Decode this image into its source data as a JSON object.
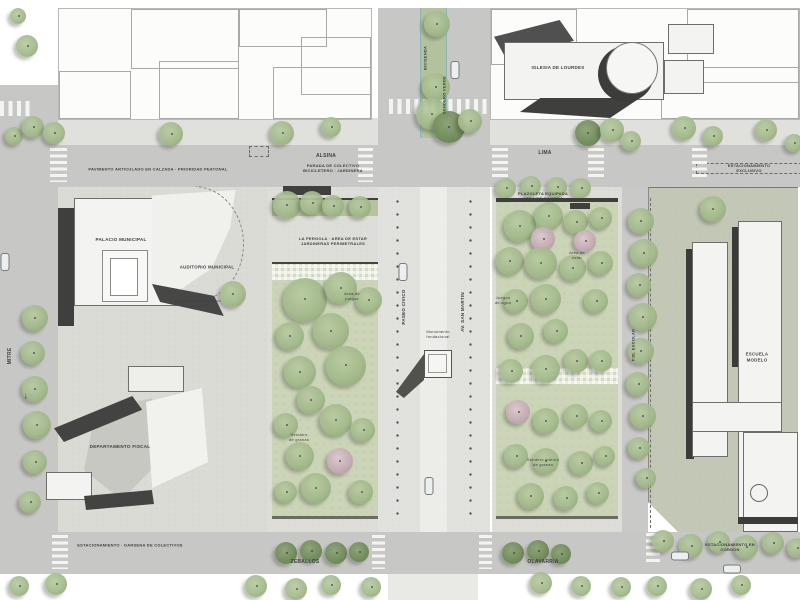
{
  "title": "Plan maestro urbano - plaza civica",
  "palette": {
    "road": "#c7c7c5",
    "sidewalk": "#e0e0dc",
    "plot_civic": "#dbdbd6",
    "plot_school": "#c3c8b6",
    "mall": "#e1e1dd",
    "mall_strip": "#ecece8",
    "lawn": "#cbd4b6",
    "pergola": "#b5c49e",
    "median": "#b2c29c",
    "building_white": "#f3f3f1",
    "building_dark": "#3f3f3d",
    "ink": "#3f4044",
    "tree_green": "#9fb687",
    "tree_dark": "#6f8a58",
    "tree_pink": "#c5abb5"
  },
  "labels": [
    {
      "name": "church-label",
      "text": "IGLESIA DE LOURDES",
      "x": 558,
      "y": 68,
      "size": 4.5,
      "rot": 0,
      "caps": true
    },
    {
      "name": "street-alsina",
      "text": "ALSINA",
      "x": 326,
      "y": 156,
      "size": 5,
      "rot": 0,
      "caps": true
    },
    {
      "name": "street-lima",
      "text": "LIMA",
      "x": 545,
      "y": 153,
      "size": 5,
      "rot": 0,
      "caps": true
    },
    {
      "name": "paving-note",
      "text": "PAVIMENTO ARTICULADO EN CALZADA · PRIORIDAD PEATONAL",
      "x": 158,
      "y": 169,
      "size": 4,
      "rot": 0,
      "caps": true
    },
    {
      "name": "bus-stop-note",
      "text": "PARADA DE COLECTIVO\nBICICLETERO · JARDINERA",
      "x": 333,
      "y": 168,
      "size": 4,
      "rot": 0,
      "caps": true
    },
    {
      "name": "parking-note-top",
      "text": "ESTACIONAMIENTO EXCLUSIVO",
      "x": 749,
      "y": 168,
      "size": 4,
      "rot": 0,
      "caps": true
    },
    {
      "name": "palacio-label",
      "text": "PALACIO MUNICIPAL",
      "x": 121,
      "y": 240,
      "size": 4.6,
      "rot": 0,
      "caps": true
    },
    {
      "name": "auditorio-label",
      "text": "AUDITORIO MUNICIPAL",
      "x": 207,
      "y": 267,
      "size": 4.4,
      "rot": 0,
      "caps": true
    },
    {
      "name": "fiscal-label",
      "text": "DEPARTAMENTO FISCAL",
      "x": 120,
      "y": 447,
      "size": 4.6,
      "rot": 0,
      "caps": true
    },
    {
      "name": "stairs-note",
      "text": "Escalera de desembarco\nal patio civico",
      "x": 196,
      "y": 303,
      "size": 4,
      "rot": 0,
      "caps": false
    },
    {
      "name": "pergola-note",
      "text": "LA PERGOLA · AREA DE ESTAR\nJARDINERAS PERIMETRALES",
      "x": 333,
      "y": 241,
      "size": 4,
      "rot": 0,
      "caps": true
    },
    {
      "name": "playground-note",
      "text": "Area de\njuegos",
      "x": 352,
      "y": 296,
      "size": 4,
      "rot": 0,
      "caps": false
    },
    {
      "name": "gravel-note-left",
      "text": "Sendero\nde granza",
      "x": 299,
      "y": 437,
      "size": 4,
      "rot": 0,
      "caps": false
    },
    {
      "name": "plazoleta-note",
      "text": "PLAZOLETA EQUIPADA\nAREA DE SOMBRA",
      "x": 543,
      "y": 196,
      "size": 4,
      "rot": 0,
      "caps": true
    },
    {
      "name": "seating-note",
      "text": "Area de\nestar",
      "x": 577,
      "y": 255,
      "size": 4,
      "rot": 0,
      "caps": false
    },
    {
      "name": "water-note",
      "text": "Juegos\nde agua",
      "x": 503,
      "y": 300,
      "size": 4,
      "rot": 0,
      "caps": false
    },
    {
      "name": "gravel-note-right",
      "text": "Sendero interno\nde granza",
      "x": 543,
      "y": 462,
      "size": 4,
      "rot": 0,
      "caps": false
    },
    {
      "name": "school-label",
      "text": "ESCUELA MODELO",
      "x": 757,
      "y": 357,
      "size": 4.4,
      "rot": 0,
      "caps": true
    },
    {
      "name": "street-zeballos",
      "text": "ZEBALLOS",
      "x": 305,
      "y": 562,
      "size": 5,
      "rot": 0,
      "caps": true
    },
    {
      "name": "street-olavarria",
      "text": "OLAVARRIA",
      "x": 543,
      "y": 562,
      "size": 5,
      "rot": 0,
      "caps": true
    },
    {
      "name": "bus-bay-note",
      "text": "ESTACIONAMIENTO · DARSENA DE COLECTIVOS",
      "x": 130,
      "y": 545,
      "size": 4,
      "rot": 0,
      "caps": true
    },
    {
      "name": "curb-parking-note",
      "text": "ESTACIONAMIENTO EN CORDON",
      "x": 730,
      "y": 547,
      "size": 4,
      "rot": 0,
      "caps": true
    },
    {
      "name": "street-mitre",
      "text": "MITRE",
      "x": 10,
      "y": 356,
      "size": 5,
      "rot": -90,
      "caps": true
    },
    {
      "name": "mall-name-west",
      "text": "PASEO CIVICO",
      "x": 404,
      "y": 307,
      "size": 4.5,
      "rot": -90,
      "caps": true
    },
    {
      "name": "mall-name-east",
      "text": "AV. SAN MARTIN",
      "x": 463,
      "y": 312,
      "size": 4.5,
      "rot": -90,
      "caps": true
    },
    {
      "name": "bike-lane-note",
      "text": "BICISENDA",
      "x": 425,
      "y": 58,
      "size": 4,
      "rot": -90,
      "caps": true
    },
    {
      "name": "green-path-note",
      "text": "SENDERO VERDE",
      "x": 444,
      "y": 95,
      "size": 4,
      "rot": -90,
      "caps": true
    },
    {
      "name": "monument-note",
      "text": "Monumento\nfundacional",
      "x": 438,
      "y": 334,
      "size": 4,
      "rot": 0,
      "caps": false
    },
    {
      "name": "school-lane",
      "text": "PJE. ESCOLAR",
      "x": 633,
      "y": 345,
      "size": 4,
      "rot": -90,
      "caps": true
    },
    {
      "name": "one-way-arrow",
      "text": "↓",
      "x": 26,
      "y": 396,
      "size": 9,
      "rot": 0,
      "caps": false
    }
  ],
  "trees": [
    [
      18,
      16,
      8,
      "g"
    ],
    [
      27,
      46,
      11,
      "g"
    ],
    [
      14,
      136,
      9,
      "g"
    ],
    [
      33,
      127,
      11,
      "g"
    ],
    [
      54,
      133,
      11,
      "g"
    ],
    [
      171,
      134,
      12,
      "g"
    ],
    [
      282,
      133,
      12,
      "g"
    ],
    [
      331,
      127,
      10,
      "g"
    ],
    [
      437,
      24,
      13,
      "g"
    ],
    [
      436,
      87,
      14,
      "g"
    ],
    [
      432,
      114,
      16,
      "g"
    ],
    [
      449,
      127,
      16,
      "d"
    ],
    [
      470,
      121,
      12,
      "g"
    ],
    [
      588,
      133,
      13,
      "d"
    ],
    [
      612,
      130,
      12,
      "g"
    ],
    [
      631,
      141,
      10,
      "g"
    ],
    [
      684,
      128,
      12,
      "g"
    ],
    [
      713,
      136,
      10,
      "g"
    ],
    [
      766,
      130,
      11,
      "g"
    ],
    [
      794,
      143,
      9,
      "g"
    ],
    [
      506,
      188,
      10,
      "g"
    ],
    [
      531,
      186,
      10,
      "g"
    ],
    [
      557,
      187,
      10,
      "g"
    ],
    [
      581,
      188,
      10,
      "g"
    ],
    [
      35,
      318,
      13,
      "g"
    ],
    [
      33,
      353,
      12,
      "g"
    ],
    [
      35,
      389,
      13,
      "g"
    ],
    [
      37,
      425,
      14,
      "g"
    ],
    [
      35,
      462,
      12,
      "g"
    ],
    [
      30,
      502,
      11,
      "g"
    ],
    [
      233,
      294,
      13,
      "g"
    ],
    [
      287,
      205,
      14,
      "g"
    ],
    [
      312,
      203,
      12,
      "g"
    ],
    [
      333,
      206,
      11,
      "g"
    ],
    [
      360,
      207,
      11,
      "g"
    ],
    [
      305,
      300,
      22,
      "g"
    ],
    [
      341,
      288,
      16,
      "g"
    ],
    [
      369,
      300,
      13,
      "g"
    ],
    [
      290,
      336,
      14,
      "g"
    ],
    [
      331,
      331,
      18,
      "g"
    ],
    [
      300,
      372,
      16,
      "g"
    ],
    [
      346,
      366,
      20,
      "g"
    ],
    [
      311,
      400,
      14,
      "g"
    ],
    [
      286,
      425,
      12,
      "g"
    ],
    [
      336,
      420,
      16,
      "g"
    ],
    [
      363,
      430,
      12,
      "g"
    ],
    [
      300,
      456,
      14,
      "g"
    ],
    [
      340,
      461,
      13,
      "p"
    ],
    [
      316,
      488,
      15,
      "g"
    ],
    [
      361,
      492,
      12,
      "g"
    ],
    [
      286,
      492,
      11,
      "g"
    ],
    [
      520,
      226,
      16,
      "g"
    ],
    [
      549,
      216,
      14,
      "g"
    ],
    [
      576,
      222,
      12,
      "g"
    ],
    [
      601,
      218,
      11,
      "g"
    ],
    [
      543,
      239,
      12,
      "p"
    ],
    [
      585,
      241,
      11,
      "p"
    ],
    [
      510,
      261,
      14,
      "g"
    ],
    [
      541,
      263,
      16,
      "g"
    ],
    [
      573,
      268,
      13,
      "g"
    ],
    [
      601,
      263,
      12,
      "g"
    ],
    [
      516,
      301,
      12,
      "g"
    ],
    [
      546,
      299,
      15,
      "g"
    ],
    [
      596,
      301,
      12,
      "g"
    ],
    [
      521,
      336,
      13,
      "g"
    ],
    [
      556,
      331,
      12,
      "g"
    ],
    [
      511,
      371,
      12,
      "g"
    ],
    [
      546,
      369,
      14,
      "g"
    ],
    [
      576,
      361,
      12,
      "g"
    ],
    [
      601,
      361,
      11,
      "g"
    ],
    [
      518,
      412,
      12,
      "p"
    ],
    [
      546,
      421,
      13,
      "g"
    ],
    [
      576,
      416,
      12,
      "g"
    ],
    [
      601,
      421,
      11,
      "g"
    ],
    [
      516,
      456,
      12,
      "g"
    ],
    [
      546,
      461,
      13,
      "g"
    ],
    [
      581,
      463,
      12,
      "g"
    ],
    [
      605,
      456,
      10,
      "g"
    ],
    [
      531,
      496,
      13,
      "g"
    ],
    [
      566,
      498,
      12,
      "g"
    ],
    [
      598,
      493,
      11,
      "g"
    ],
    [
      641,
      221,
      13,
      "g"
    ],
    [
      644,
      253,
      14,
      "g"
    ],
    [
      639,
      285,
      12,
      "g"
    ],
    [
      643,
      317,
      14,
      "g"
    ],
    [
      641,
      351,
      13,
      "g"
    ],
    [
      638,
      384,
      12,
      "g"
    ],
    [
      643,
      416,
      13,
      "g"
    ],
    [
      639,
      448,
      11,
      "g"
    ],
    [
      646,
      478,
      10,
      "g"
    ],
    [
      713,
      209,
      13,
      "g"
    ],
    [
      663,
      541,
      11,
      "g"
    ],
    [
      691,
      546,
      12,
      "g"
    ],
    [
      719,
      542,
      11,
      "g"
    ],
    [
      746,
      547,
      12,
      "g"
    ],
    [
      773,
      543,
      11,
      "g"
    ],
    [
      797,
      548,
      10,
      "g"
    ],
    [
      286,
      553,
      11,
      "d"
    ],
    [
      311,
      551,
      11,
      "d"
    ],
    [
      336,
      553,
      11,
      "d"
    ],
    [
      359,
      552,
      10,
      "d"
    ],
    [
      513,
      553,
      11,
      "d"
    ],
    [
      538,
      551,
      11,
      "d"
    ],
    [
      561,
      554,
      10,
      "d"
    ],
    [
      19,
      586,
      10,
      "g"
    ],
    [
      56,
      584,
      11,
      "g"
    ],
    [
      256,
      586,
      11,
      "g"
    ],
    [
      296,
      589,
      11,
      "g"
    ],
    [
      331,
      585,
      10,
      "g"
    ],
    [
      371,
      587,
      10,
      "g"
    ],
    [
      541,
      583,
      11,
      "g"
    ],
    [
      581,
      586,
      10,
      "g"
    ],
    [
      621,
      587,
      10,
      "g"
    ],
    [
      657,
      586,
      10,
      "g"
    ],
    [
      701,
      589,
      11,
      "g"
    ],
    [
      741,
      585,
      10,
      "g"
    ]
  ],
  "cars": [
    [
      403,
      272,
      "v"
    ],
    [
      429,
      486,
      "v"
    ],
    [
      5,
      262,
      "v"
    ],
    [
      455,
      70,
      "v"
    ],
    [
      680,
      556,
      "h"
    ],
    [
      732,
      569,
      "h"
    ]
  ],
  "crosswalks": [
    [
      50,
      148,
      17,
      34,
      "h"
    ],
    [
      358,
      148,
      15,
      34,
      "h"
    ],
    [
      492,
      148,
      16,
      32,
      "h"
    ],
    [
      588,
      148,
      16,
      32,
      "h"
    ],
    [
      692,
      148,
      15,
      32,
      "h"
    ],
    [
      52,
      535,
      16,
      34,
      "h"
    ],
    [
      372,
      535,
      13,
      34,
      "h"
    ],
    [
      479,
      535,
      13,
      34,
      "h"
    ],
    [
      646,
      533,
      14,
      30,
      "h"
    ],
    [
      389,
      99,
      98,
      15,
      "v"
    ],
    [
      0,
      101,
      30,
      15,
      "v"
    ]
  ]
}
